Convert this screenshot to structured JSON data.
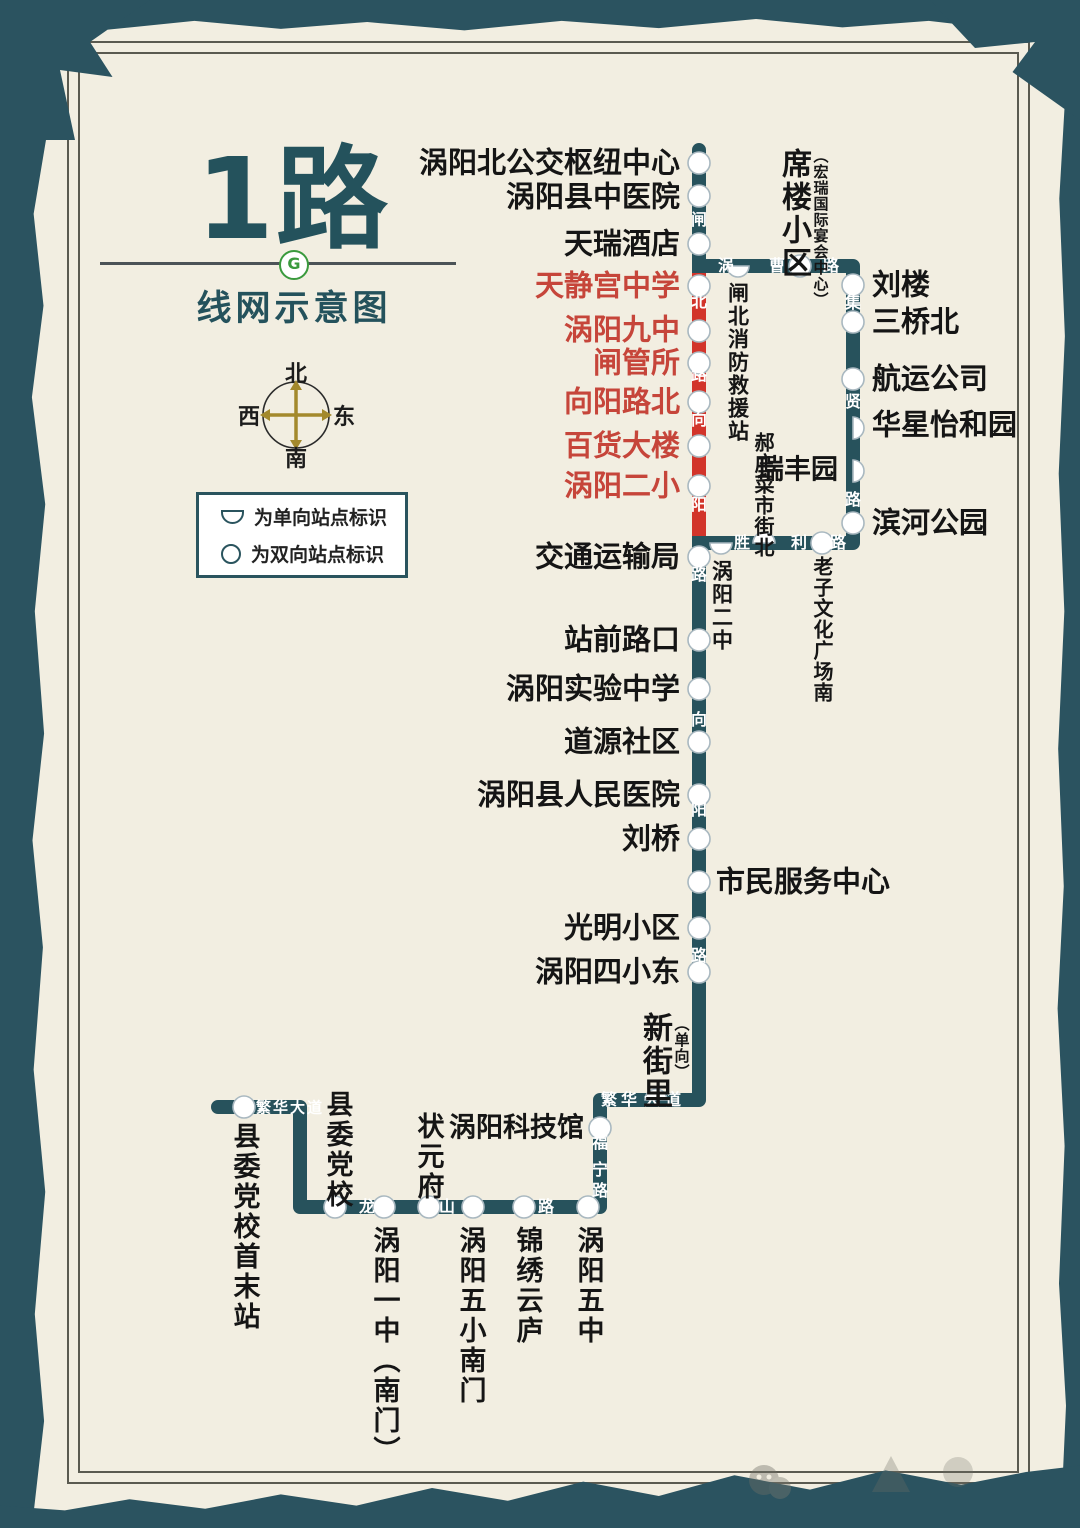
{
  "title": {
    "route": "1路",
    "subtitle": "线网示意图",
    "brand": "G"
  },
  "compass": {
    "n": "北",
    "s": "南",
    "w": "西",
    "e": "东"
  },
  "legend": {
    "oneway": "为单向站点标识",
    "twoway": "为双向站点标识"
  },
  "colors": {
    "line": "#27525c",
    "oneway_section": "#d2342a",
    "paper": "#f2eee1",
    "frame_band": "#2b5360",
    "red_text": "#c6453a"
  },
  "stations": {
    "hub": "涡阳北公交枢纽中心",
    "zhongyiyuan": "涡阳县中医院",
    "tianrui": "天瑞酒店",
    "tianjinggong": "天静宫中学",
    "jiuzhong": "涡阳九中",
    "zhaguansuo": "闸管所",
    "xiangyanglubei": "向阳路北",
    "baihuodalou": "百货大楼",
    "erxiao": "涡阳二小",
    "jiaotongju": "交通运输局",
    "zhanqianlukou": "站前路口",
    "shiyanzhongxue": "涡阳实验中学",
    "daoyuanshequ": "道源社区",
    "renminyiyuan": "涡阳县人民医院",
    "liuqiao": "刘桥",
    "shiminzhongxin": "市民服务中心",
    "guangmingxiaoqu": "光明小区",
    "sixiaodong": "涡阳四小东",
    "xinjieli": "新街里",
    "xinjieli_note": "（单向）",
    "xilouxiaoqu": "席楼小区",
    "xilou_note": "（宏瑞国际宴会中心）",
    "liulou": "刘楼",
    "sanqiaobei": "三桥北",
    "hangyungongsi": "航运公司",
    "huaxingyiheyuan": "华星怡和园",
    "ruifengyuan": "瑞丰园",
    "binhegongyuan": "滨河公园",
    "xiaofangzhan": "闸北消防救援站",
    "haozhuang": "郝庄菜市街北",
    "laozi": "老子文化广场南",
    "erzhong": "涡阳二中",
    "kejiguan": "涡阳科技馆",
    "zhuangyuanfu": "状元府",
    "xianweidangxiao": "县委党校",
    "shoumozhan": "县委党校首末站",
    "yizhong": "涡阳一中（南门）",
    "wuxiaonanmen": "涡阳五小南门",
    "jinxiuyunlu": "锦绣云庐",
    "wuzhong": "涡阳五中"
  },
  "roads": {
    "zhabei": [
      "闸",
      "北",
      "路"
    ],
    "xiangyang_upper": [
      "向",
      "阳",
      "路"
    ],
    "xiangyang_lower": [
      "向",
      "阳",
      "路"
    ],
    "wocao": [
      "涡",
      "曹",
      "路"
    ],
    "jixian": [
      "集",
      "贤",
      "路"
    ],
    "shengli": [
      "胜",
      "利",
      "路"
    ],
    "fanhua": [
      "繁",
      "华",
      "大",
      "道"
    ],
    "fanhua_terminus": "繁华大道",
    "funing": [
      "福",
      "宁",
      "路"
    ],
    "longshan": [
      "龙",
      "山",
      "路"
    ]
  }
}
